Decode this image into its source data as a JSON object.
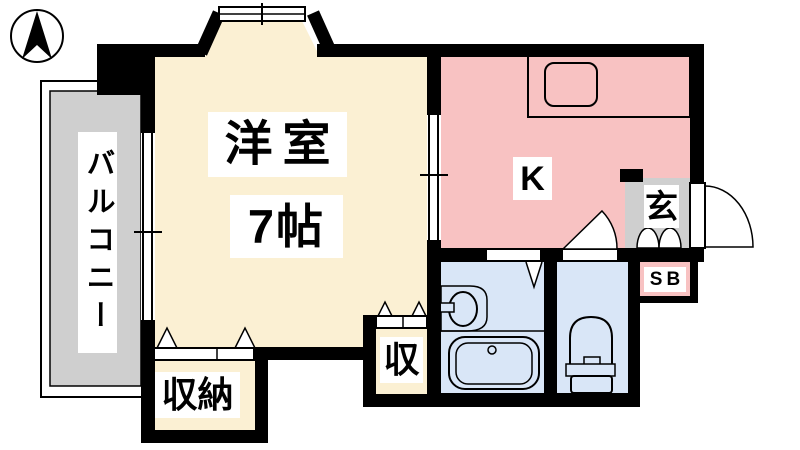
{
  "title": "1K apartment floor plan",
  "colors": {
    "wall": "#000000",
    "room": "#FBF0D3",
    "kitchen": "#F8C2C2",
    "wet": "#D9E6F7",
    "balcony": "#CFCFCF",
    "label_bg": "#FFFFFF"
  },
  "rooms": {
    "western_room": {
      "label": "洋室",
      "size": "7帖"
    },
    "kitchen": {
      "label": "K"
    },
    "balcony": {
      "label": "バルコニー"
    },
    "closet_large": {
      "label": "収納"
    },
    "closet_small": {
      "label": "収"
    },
    "entrance": {
      "label": "玄"
    },
    "shoe_box": {
      "label": "SB"
    }
  }
}
